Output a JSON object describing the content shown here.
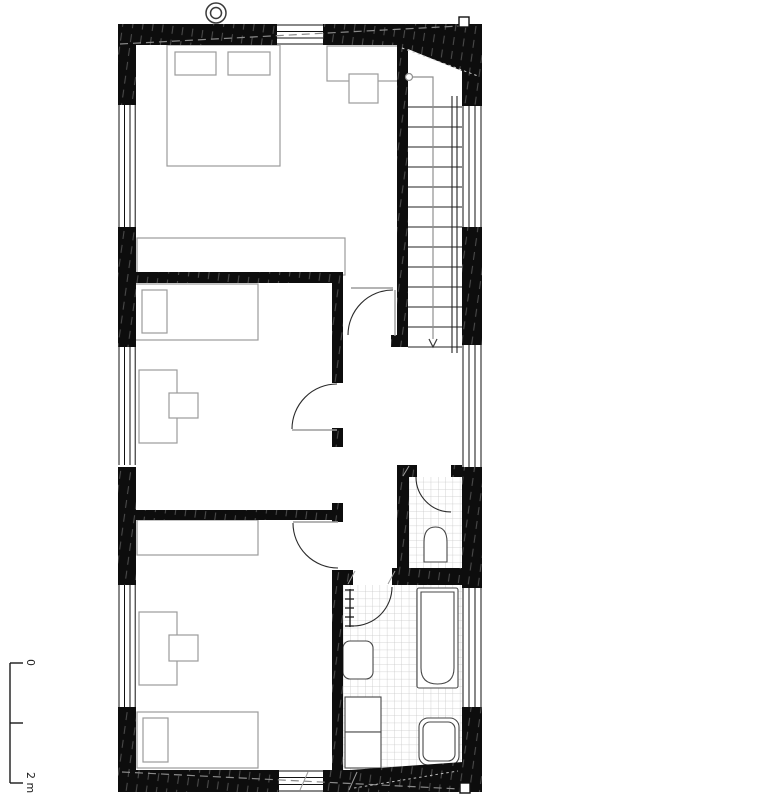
{
  "scale_bar": {
    "label_start": "0",
    "label_end": "2 m"
  },
  "colors": {
    "walls": "#0d0d0d",
    "furniture_outline": "#9b9b9b",
    "fixture_outline": "#474747",
    "tile_grid": "#c9c9c9",
    "door_swing": "#2b2b2b",
    "stair_guide": "#8f8f8f",
    "background": "#ffffff"
  },
  "symbols": {
    "roof_vent": "double-circle-icon",
    "stair_direction": "down-arrow-icon",
    "corner_marker": "small-square-icon",
    "roof_line": "dashed-diagonal-line"
  }
}
